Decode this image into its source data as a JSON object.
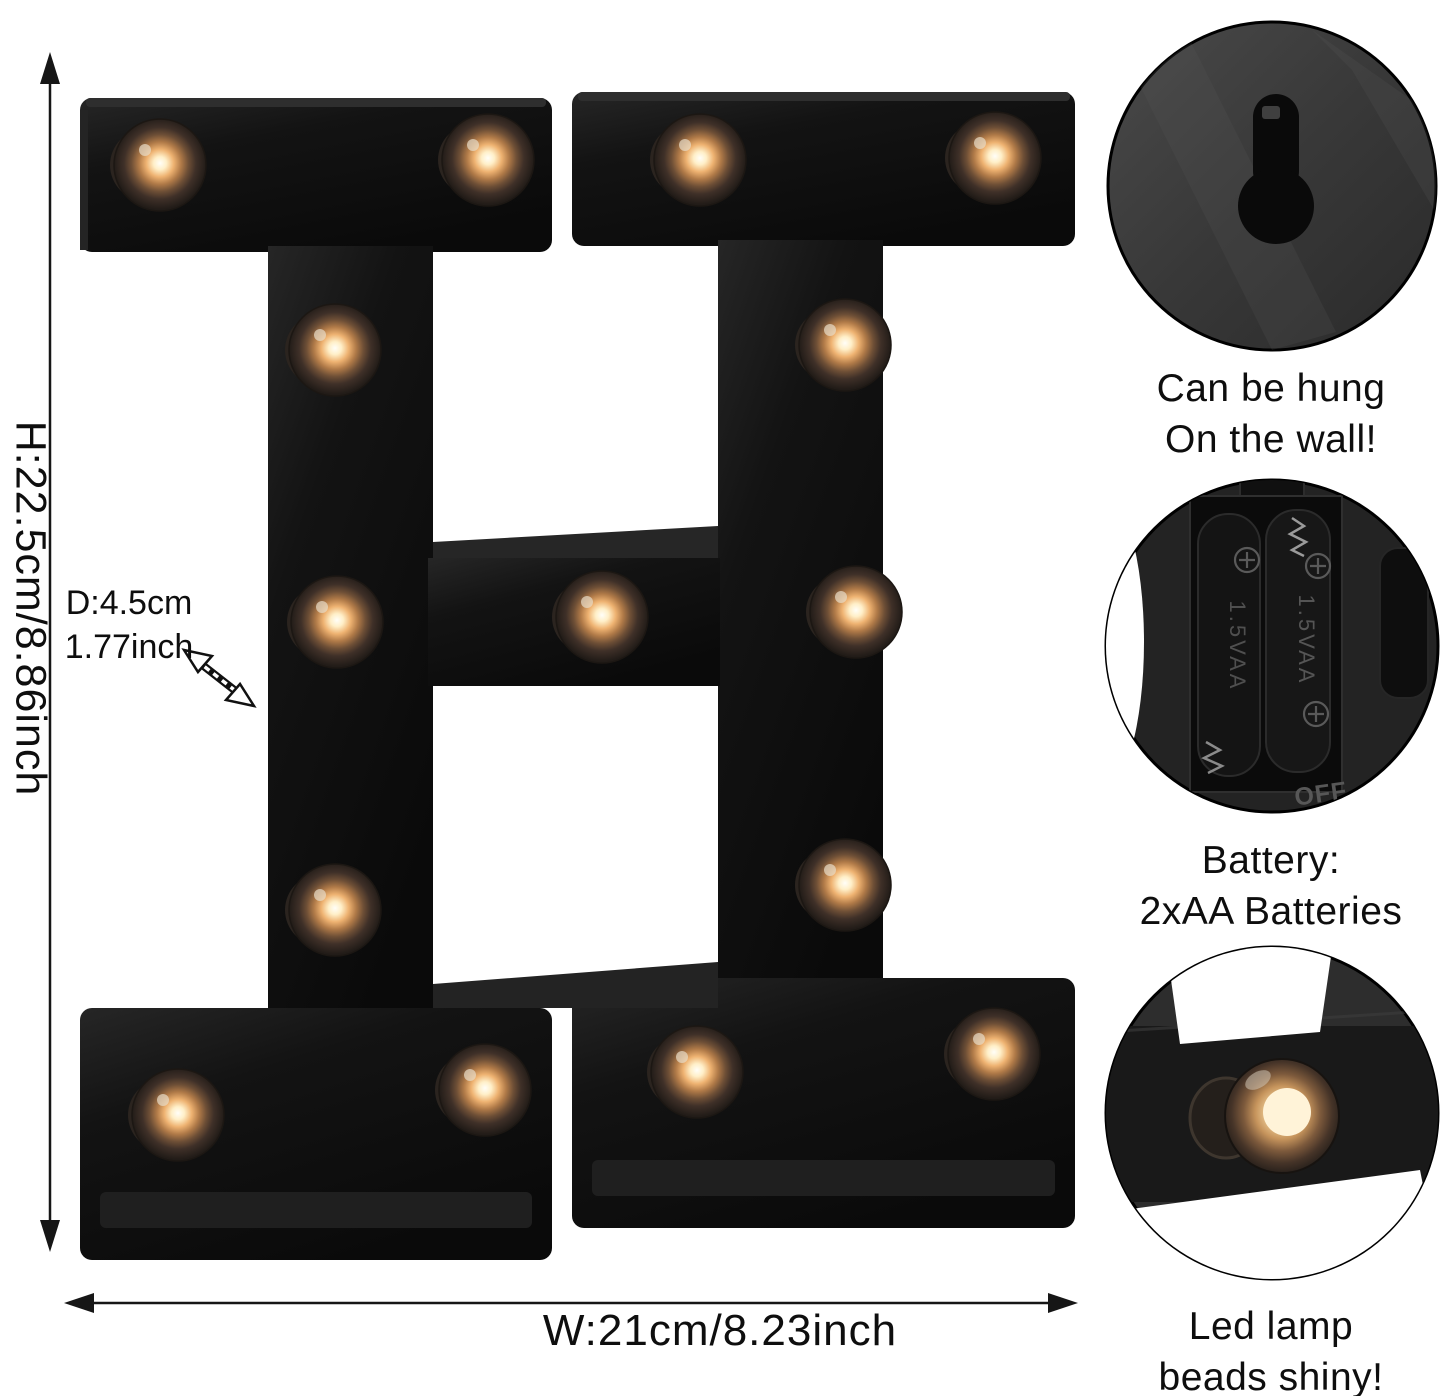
{
  "product": {
    "letter": "H"
  },
  "dimension_labels": {
    "height": "H:22.5cm/8.86inch",
    "depth_line1": "D:4.5cm",
    "depth_line2": "1.77inch",
    "width": "W:21cm/8.23inch"
  },
  "callouts": [
    {
      "name": "wall-hang",
      "lines": [
        "Can be hung",
        "On the wall!"
      ]
    },
    {
      "name": "battery",
      "lines": [
        "Battery:",
        "2xAA Batteries"
      ],
      "battery_print": "1.5VAA",
      "switch_print": "OFF"
    },
    {
      "name": "led-beads",
      "lines": [
        "Led lamp",
        "beads shiny!"
      ]
    }
  ],
  "colors": {
    "background": "#ffffff",
    "letter_black": "#101010",
    "bulb_core": "#fffdf2",
    "bulb_warm": "#eeb271",
    "bulb_rim": "#6e4f36",
    "callout_circle_gray": "#3a3a3a",
    "annotation_black": "#111111"
  },
  "bulbs": {
    "count": 15,
    "positions": [
      [
        160,
        165
      ],
      [
        488,
        160
      ],
      [
        700,
        160
      ],
      [
        995,
        158
      ],
      [
        335,
        350
      ],
      [
        845,
        345
      ],
      [
        337,
        622
      ],
      [
        602,
        617
      ],
      [
        856,
        612
      ],
      [
        335,
        910
      ],
      [
        845,
        885
      ],
      [
        178,
        1115
      ],
      [
        485,
        1090
      ],
      [
        697,
        1072
      ],
      [
        994,
        1054
      ]
    ]
  }
}
